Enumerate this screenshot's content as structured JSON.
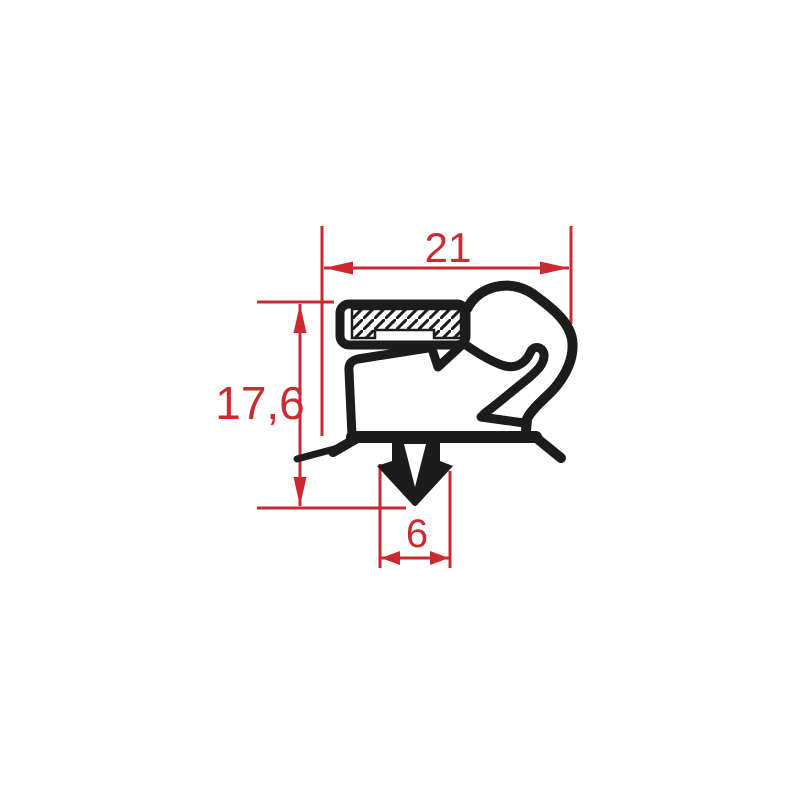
{
  "diagram": {
    "name": "gasket-profile-cross-section",
    "colors": {
      "background": "#ffffff",
      "ink": "#1c1c1c",
      "dimension": "#ca2a30"
    },
    "dimensions": {
      "width": {
        "label": "21",
        "value": 21
      },
      "height": {
        "label": "17,6",
        "value": 17.6
      },
      "foot_width": {
        "label": "6",
        "value": 6
      }
    }
  }
}
